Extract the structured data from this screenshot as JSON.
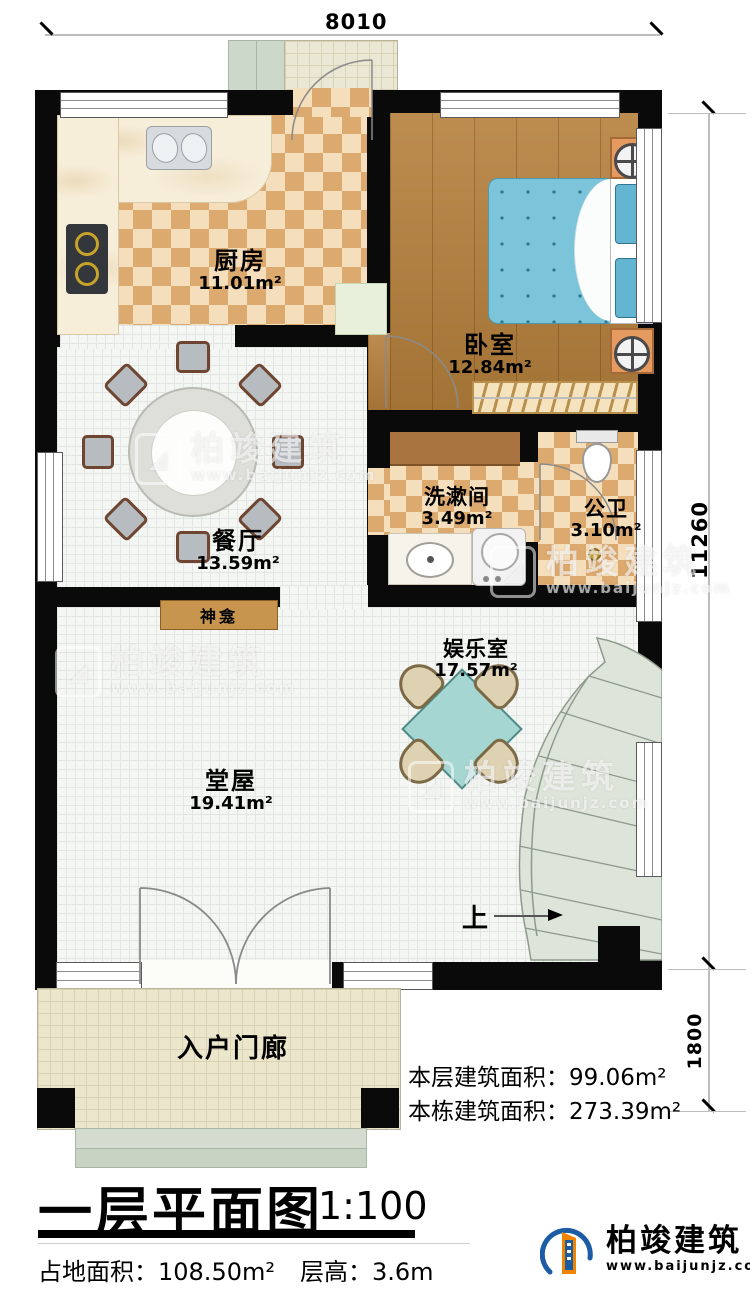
{
  "dimensions": {
    "top": "8010",
    "side": "11260",
    "porch": "1800"
  },
  "rooms": {
    "kitchen": {
      "name": "厨房",
      "area": "11.01m²"
    },
    "bedroom": {
      "name": "卧室",
      "area": "12.84m²"
    },
    "dining": {
      "name": "餐厅",
      "area": "13.59m²"
    },
    "washroom": {
      "name": "洗漱间",
      "area": "3.49m²"
    },
    "bathroom": {
      "name": "公卫",
      "area": "3.10m²"
    },
    "shrine": {
      "name": "神龛"
    },
    "entertainment": {
      "name": "娱乐室",
      "area": "17.57m²"
    },
    "hall": {
      "name": "堂屋",
      "area": "19.41m²"
    },
    "porch": {
      "name": "入户门廊"
    },
    "stairs": {
      "up_label": "上"
    }
  },
  "stats": {
    "floor_area_label": "本层建筑面积：",
    "floor_area_value": "99.06m²",
    "building_area_label": "本栋建筑面积：",
    "building_area_value": "273.39m²"
  },
  "footer": {
    "title": "一层平面图",
    "scale": "1:100",
    "land_area_label": "占地面积：",
    "land_area_value": "108.50m²",
    "floor_height_label": "层高：",
    "floor_height_value": "3.6m"
  },
  "brand": {
    "name": "柏竣建筑",
    "url": "www.baijunjz.com"
  },
  "watermark": {
    "name": "柏竣建筑",
    "url": "www.baijunjz.com"
  },
  "colors": {
    "wall": "#0a0a0a",
    "checker_dark": "#dca96e",
    "checker_light": "#f5debb",
    "wood": "#b5803c",
    "bed": "#7cc4da",
    "stairs_fill": "#dde4d9",
    "tile": "#f4f6f3",
    "porch_tile": "#ece6cd",
    "brand_blue": "#1c5ca5",
    "brand_orange": "#f08300"
  }
}
